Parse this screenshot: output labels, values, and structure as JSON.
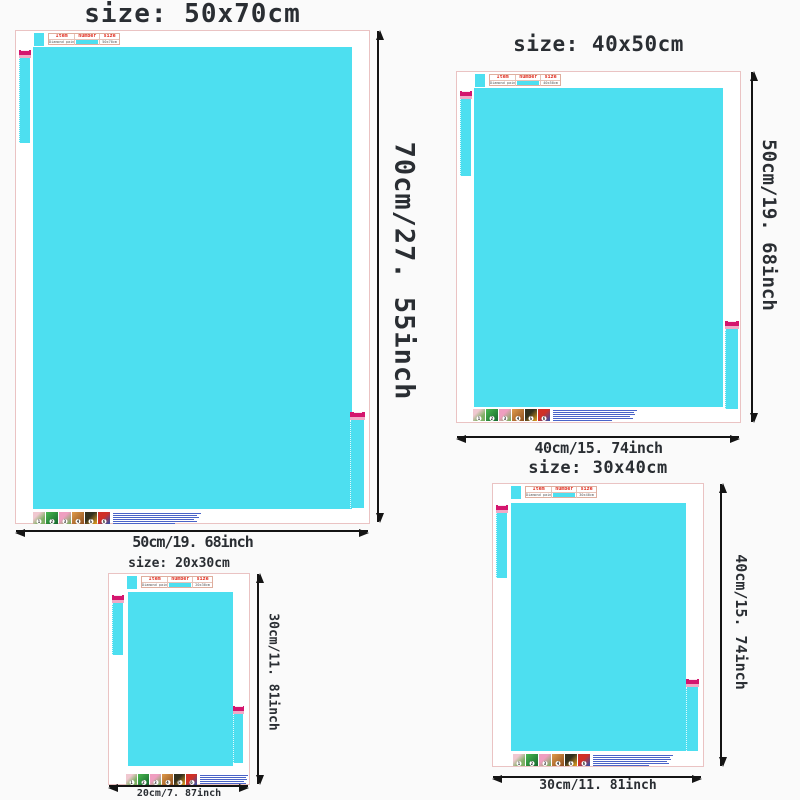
{
  "colors": {
    "cyan": "#4ddff0",
    "pink": "#d4156e",
    "lightpink": "#f2a8c6",
    "red": "#e03022",
    "border": "#eac3c3",
    "arrow": "#141414",
    "blue": "#4a63c8",
    "bg": "#fafafa",
    "text": "#2a2e33"
  },
  "table": {
    "headers": [
      "Item",
      "number",
      "size"
    ],
    "item": "Diamond painting"
  },
  "steps": [
    "1",
    "2",
    "3",
    "4",
    "5",
    "6"
  ],
  "panels": [
    {
      "title": "size: 50x70cm",
      "table_size": "50x70cm",
      "width_label": "50cm/19. 68inch",
      "height_label": "70cm/27. 55inch"
    },
    {
      "title": "size: 40x50cm",
      "table_size": "40x50cm",
      "width_label": "40cm/15. 74inch",
      "height_label": "50cm/19. 68inch"
    },
    {
      "title": "size: 30x40cm",
      "table_size": "30x40cm",
      "width_label": "30cm/11. 81inch",
      "height_label": "40cm/15. 74inch"
    },
    {
      "title": "size: 20x30cm",
      "table_size": "20x30cm",
      "width_label": "20cm/7. 87inch",
      "height_label": "30cm/11. 81inch"
    }
  ]
}
